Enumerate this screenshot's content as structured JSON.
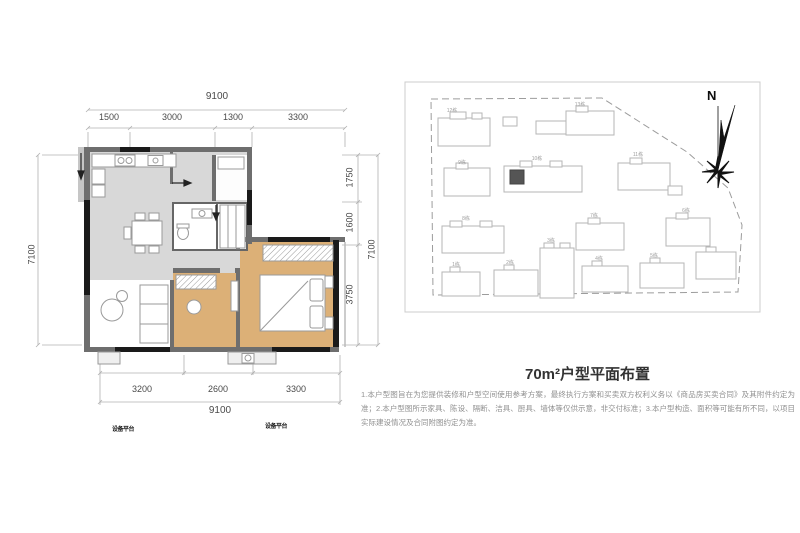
{
  "title": "70m²户型平面布置",
  "disclaimer": "1.本户型图旨在为您提供装修和户型空间使用参考方案，最终执行方案和买卖双方权利义务以《商品房买卖合同》及其附件约定为准；2.本户型图所示家具、陈设、隔断、洁具、厨具、墙体等仅供示意，非交付标准；3.本户型构造、面积等可能有所不同，以项目实际建设情况及合同附图约定为准。",
  "floor_plan": {
    "dim_top_total": "9100",
    "dim_top_segments": [
      "1500",
      "3000",
      "1300",
      "3300"
    ],
    "dim_left_total": "7100",
    "dim_right_segments": [
      "1750",
      "1600",
      "3750"
    ],
    "dim_right_total": "7100",
    "dim_bottom_segments": [
      "3200",
      "2600",
      "3300"
    ],
    "dim_bottom_total": "9100",
    "annotations": [
      "设备平台",
      "设备平台"
    ]
  },
  "site_plan": {
    "north_label": "N",
    "highlighted_building": "10栋",
    "buildings": [
      {
        "label": "12栋"
      },
      {
        "label": "13栋"
      },
      {
        "label": "9栋"
      },
      {
        "label": "10栋"
      },
      {
        "label": "11栋"
      },
      {
        "label": "8栋"
      },
      {
        "label": "7栋"
      },
      {
        "label": "6栋"
      },
      {
        "label": "1栋"
      },
      {
        "label": "2栋"
      },
      {
        "label": "3栋"
      },
      {
        "label": "4栋"
      },
      {
        "label": "5栋"
      }
    ]
  },
  "colors": {
    "floor_gray": "#d8d8d8",
    "floor_tan": "#dcb077",
    "wall_gray": "#6e6e6e",
    "wall_black": "#1a1a1a",
    "highlight_unit": "#555555",
    "site_outline": "#b5b5b5"
  }
}
